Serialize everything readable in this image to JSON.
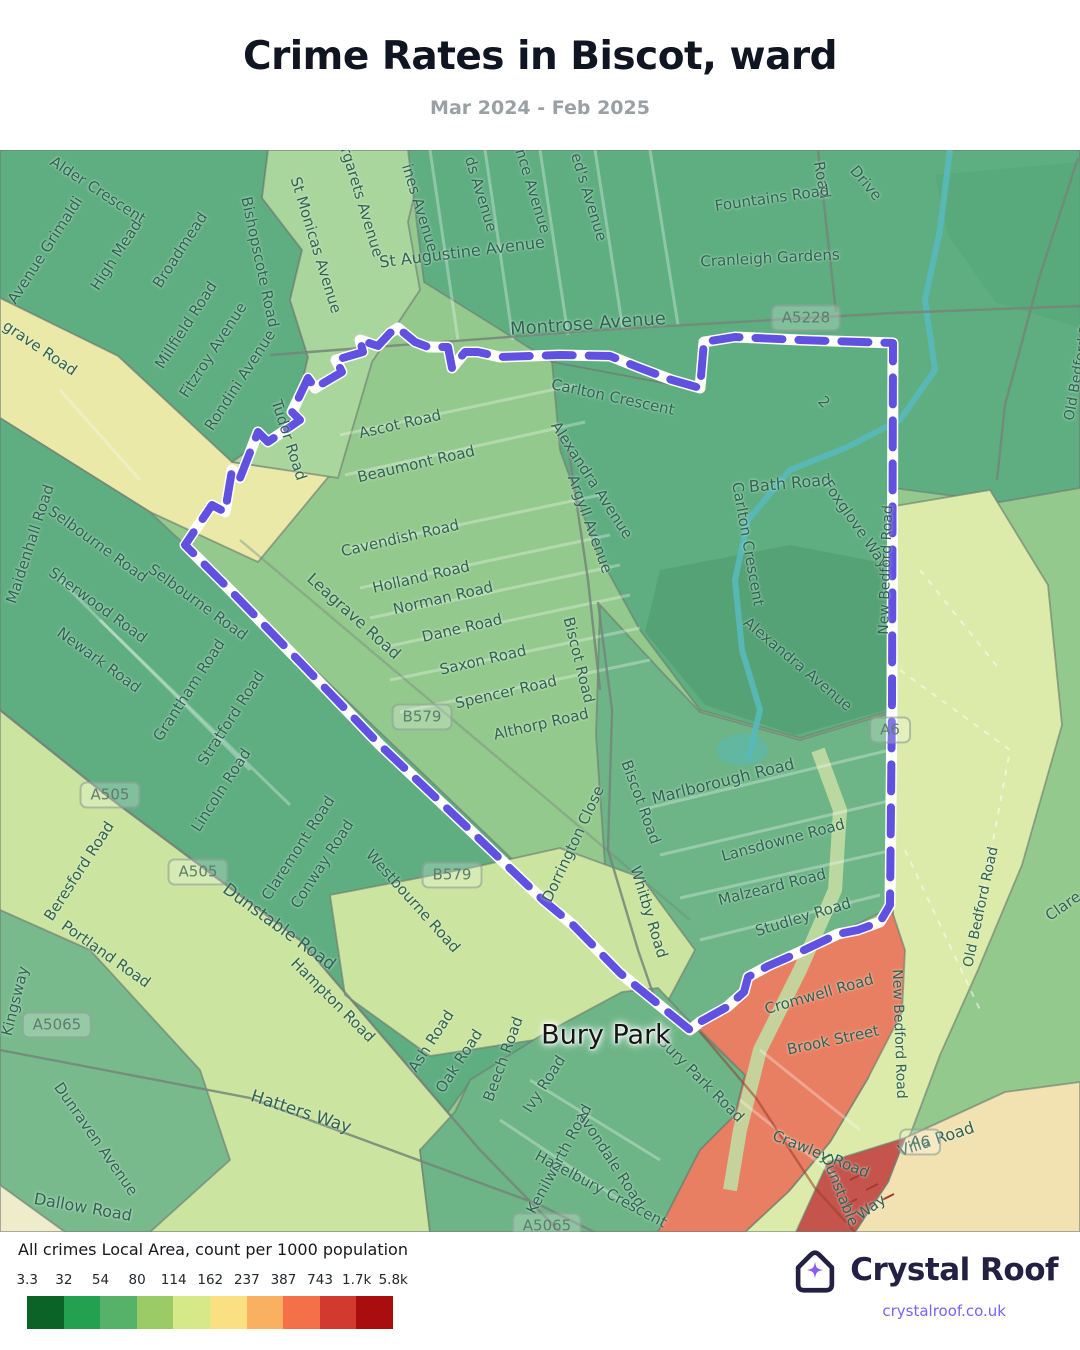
{
  "header": {
    "title": "Crime Rates in Biscot, ward",
    "subtitle": "Mar 2024 - Feb 2025"
  },
  "legend": {
    "title": "All crimes Local Area, count per 1000 population",
    "ticks": [
      "3.3",
      "32",
      "54",
      "80",
      "114",
      "162",
      "237",
      "387",
      "743",
      "1.7k",
      "5.8k"
    ],
    "colors": [
      "#0b6327",
      "#23a151",
      "#57b269",
      "#9acb66",
      "#d6e988",
      "#fbe083",
      "#f9b061",
      "#f37049",
      "#d23a30",
      "#aa0d0e"
    ]
  },
  "branding": {
    "name": "Crystal Roof",
    "url": "crystalroof.co.uk",
    "icon": "crystal-roof-house-icon",
    "star_color": "#8a5cf0",
    "navy": "#232043",
    "link_color": "#7b61f8"
  },
  "map": {
    "boundary_color": "#6151e1",
    "palette": {
      "sea_green": "#5fae81",
      "mid_green": "#6db586",
      "light_green": "#94c98d",
      "pale_green": "#cbe49f",
      "pale_yellow": "#eae9a8",
      "park": "#dcebaa",
      "salmon": "#e87f62",
      "cream": "#f2e2b2",
      "dark_red": "#c5544c",
      "stream": "#58b9ba"
    },
    "place_labels": [
      {
        "text": "Bury Park",
        "x": 606,
        "y": 885,
        "rot": 0
      }
    ],
    "badges": [
      {
        "text": "A5228",
        "x": 806,
        "y": 168,
        "rot": 0
      },
      {
        "text": "A505",
        "x": 110,
        "y": 645,
        "rot": 0
      },
      {
        "text": "A505",
        "x": 198,
        "y": 722,
        "rot": 0
      },
      {
        "text": "A5065",
        "x": 57,
        "y": 875,
        "rot": 0
      },
      {
        "text": "A5065",
        "x": 547,
        "y": 1076,
        "rot": 0
      },
      {
        "text": "B579",
        "x": 422,
        "y": 567,
        "rot": 0
      },
      {
        "text": "B579",
        "x": 452,
        "y": 725,
        "rot": 0
      },
      {
        "text": "A6",
        "x": 890,
        "y": 580,
        "rot": 0
      },
      {
        "text": "A6",
        "x": 920,
        "y": 992,
        "rot": 0
      }
    ],
    "road_labels": [
      {
        "text": "Alder Crescent",
        "x": 98,
        "y": 40,
        "rot": 33
      },
      {
        "text": "Avenue Grimaldi",
        "x": 45,
        "y": 100,
        "rot": -57
      },
      {
        "text": "High Mead",
        "x": 116,
        "y": 105,
        "rot": -57
      },
      {
        "text": "Broadmead",
        "x": 180,
        "y": 100,
        "rot": -57
      },
      {
        "text": "Millfield Road",
        "x": 186,
        "y": 175,
        "rot": -57
      },
      {
        "text": "Fitzroy Avenue",
        "x": 213,
        "y": 200,
        "rot": -57
      },
      {
        "text": "Rondini Avenue",
        "x": 240,
        "y": 230,
        "rot": -57
      },
      {
        "text": "Bishopscote Road",
        "x": 260,
        "y": 112,
        "rot": 78
      },
      {
        "text": "St Monicas Avenue",
        "x": 316,
        "y": 95,
        "rot": 73
      },
      {
        "text": "rgarets Avenue",
        "x": 362,
        "y": 52,
        "rot": 73
      },
      {
        "text": "Tudor Road",
        "x": 289,
        "y": 290,
        "rot": 72
      },
      {
        "text": "ines Avenue",
        "x": 420,
        "y": 58,
        "rot": 73
      },
      {
        "text": "ds Avenue",
        "x": 481,
        "y": 44,
        "rot": 73
      },
      {
        "text": "nce Avenue",
        "x": 533,
        "y": 41,
        "rot": 73
      },
      {
        "text": "ed's Avenue",
        "x": 589,
        "y": 47,
        "rot": 73
      },
      {
        "text": "Road",
        "x": 822,
        "y": 30,
        "rot": 80
      },
      {
        "text": "Drive",
        "x": 866,
        "y": 33,
        "rot": 50
      },
      {
        "text": "St Augustine Avenue",
        "x": 462,
        "y": 102,
        "rot": -7,
        "size": 16
      },
      {
        "text": "Montrose Avenue",
        "x": 588,
        "y": 174,
        "rot": -4,
        "size": 18
      },
      {
        "text": "Fountains Road",
        "x": 772,
        "y": 48,
        "rot": -8
      },
      {
        "text": "Cranleigh Gardens",
        "x": 770,
        "y": 108,
        "rot": -3
      },
      {
        "text": "Carlton Crescent",
        "x": 613,
        "y": 247,
        "rot": 12
      },
      {
        "text": "Alexandra Avenue",
        "x": 592,
        "y": 330,
        "rot": 57
      },
      {
        "text": "Bath Road",
        "x": 790,
        "y": 333,
        "rot": -5,
        "size": 16
      },
      {
        "text": "Carlton Crescent",
        "x": 748,
        "y": 394,
        "rot": 80
      },
      {
        "text": "Foxglove Way",
        "x": 856,
        "y": 374,
        "rot": 55
      },
      {
        "text": "Alexandra Avenue",
        "x": 798,
        "y": 514,
        "rot": 40
      },
      {
        "text": "2",
        "x": 824,
        "y": 252,
        "rot": 45
      },
      {
        "text": "grave Road",
        "x": 40,
        "y": 198,
        "rot": 34
      },
      {
        "text": "Maidenhall Road",
        "x": 30,
        "y": 394,
        "rot": -72
      },
      {
        "text": "Selbourne Road",
        "x": 98,
        "y": 394,
        "rot": 36
      },
      {
        "text": "Selbourne Road",
        "x": 198,
        "y": 452,
        "rot": 36
      },
      {
        "text": "Sherwood Road",
        "x": 98,
        "y": 455,
        "rot": 36
      },
      {
        "text": "Newark Road",
        "x": 99,
        "y": 510,
        "rot": 36
      },
      {
        "text": "Grantham Road",
        "x": 189,
        "y": 540,
        "rot": -57
      },
      {
        "text": "Stratford Road",
        "x": 231,
        "y": 568,
        "rot": -57
      },
      {
        "text": "Lincoln Road",
        "x": 221,
        "y": 640,
        "rot": -57
      },
      {
        "text": "Claremont Road",
        "x": 298,
        "y": 698,
        "rot": -57
      },
      {
        "text": "Conway Road",
        "x": 322,
        "y": 714,
        "rot": -57
      },
      {
        "text": "Leagrave Road",
        "x": 354,
        "y": 466,
        "rot": 42,
        "size": 16
      },
      {
        "text": "Ascot Road",
        "x": 400,
        "y": 274,
        "rot": -13
      },
      {
        "text": "Beaumont Road",
        "x": 416,
        "y": 314,
        "rot": -13
      },
      {
        "text": "Cavendish Road",
        "x": 400,
        "y": 388,
        "rot": -13
      },
      {
        "text": "Holland Road",
        "x": 421,
        "y": 427,
        "rot": -13
      },
      {
        "text": "Norman Road",
        "x": 443,
        "y": 448,
        "rot": -13
      },
      {
        "text": "Dane Road",
        "x": 462,
        "y": 478,
        "rot": -13
      },
      {
        "text": "Saxon Road",
        "x": 483,
        "y": 510,
        "rot": -13
      },
      {
        "text": "Spencer Road",
        "x": 506,
        "y": 542,
        "rot": -13
      },
      {
        "text": "Althorp Road",
        "x": 541,
        "y": 574,
        "rot": -13
      },
      {
        "text": "Argyll Avenue",
        "x": 590,
        "y": 374,
        "rot": 70
      },
      {
        "text": "Biscot Road",
        "x": 579,
        "y": 510,
        "rot": 76
      },
      {
        "text": "Biscot Road",
        "x": 641,
        "y": 652,
        "rot": 70
      },
      {
        "text": "Dorrington Close",
        "x": 573,
        "y": 694,
        "rot": -65
      },
      {
        "text": "Marlborough Road",
        "x": 723,
        "y": 631,
        "rot": -14,
        "size": 16
      },
      {
        "text": "Lansdowne Road",
        "x": 783,
        "y": 690,
        "rot": -15
      },
      {
        "text": "Malzeard Road",
        "x": 772,
        "y": 737,
        "rot": -14
      },
      {
        "text": "Studley Road",
        "x": 803,
        "y": 767,
        "rot": -17
      },
      {
        "text": "Whitby Road",
        "x": 649,
        "y": 762,
        "rot": 73
      },
      {
        "text": "Cromwell Road",
        "x": 819,
        "y": 844,
        "rot": -16
      },
      {
        "text": "Brook Street",
        "x": 833,
        "y": 890,
        "rot": -12
      },
      {
        "text": "Crawley Road",
        "x": 821,
        "y": 1004,
        "rot": 22
      },
      {
        "text": "Way",
        "x": 871,
        "y": 1057,
        "rot": -35
      },
      {
        "text": "Dunstable",
        "x": 840,
        "y": 1040,
        "rot": 68
      },
      {
        "text": "New Bedford Road",
        "x": 886,
        "y": 420,
        "rot": -88,
        "size": 14
      },
      {
        "text": "New Bedford Road",
        "x": 899,
        "y": 884,
        "rot": 88,
        "size": 14
      },
      {
        "text": "Old Bedford Road",
        "x": 981,
        "y": 757,
        "rot": -78,
        "size": 14
      },
      {
        "text": "Old Bedford Road",
        "x": 1080,
        "y": 210,
        "rot": -80,
        "size": 14
      },
      {
        "text": "Villa Road",
        "x": 936,
        "y": 989,
        "rot": -18,
        "size": 16
      },
      {
        "text": "Clare",
        "x": 1063,
        "y": 756,
        "rot": -35
      },
      {
        "text": "Beresford Road",
        "x": 79,
        "y": 721,
        "rot": -57
      },
      {
        "text": "Portland Road",
        "x": 106,
        "y": 804,
        "rot": 35
      },
      {
        "text": "Dunstable Road",
        "x": 279,
        "y": 777,
        "rot": 36,
        "size": 17
      },
      {
        "text": "Hampton Road",
        "x": 333,
        "y": 850,
        "rot": 45
      },
      {
        "text": "Kingsway",
        "x": 15,
        "y": 851,
        "rot": -76
      },
      {
        "text": "Dunraven Avenue",
        "x": 96,
        "y": 989,
        "rot": 55
      },
      {
        "text": "Dallow Road",
        "x": 83,
        "y": 1057,
        "rot": 10,
        "size": 16
      },
      {
        "text": "Hatters Way",
        "x": 301,
        "y": 962,
        "rot": 18,
        "size": 17
      },
      {
        "text": "Westbourne Road",
        "x": 413,
        "y": 751,
        "rot": 48
      },
      {
        "text": "Ash Road",
        "x": 431,
        "y": 891,
        "rot": -57
      },
      {
        "text": "Oak Road",
        "x": 459,
        "y": 911,
        "rot": -57
      },
      {
        "text": "Beech Road",
        "x": 503,
        "y": 909,
        "rot": -70
      },
      {
        "text": "Ivy Road",
        "x": 544,
        "y": 934,
        "rot": -57
      },
      {
        "text": "Kenilworth Road",
        "x": 559,
        "y": 1009,
        "rot": -62
      },
      {
        "text": "Avondale Road",
        "x": 611,
        "y": 1009,
        "rot": 57
      },
      {
        "text": "Hazelbury Crescent",
        "x": 601,
        "y": 1039,
        "rot": 28
      },
      {
        "text": "Bury Park Road",
        "x": 701,
        "y": 929,
        "rot": 45
      }
    ]
  }
}
